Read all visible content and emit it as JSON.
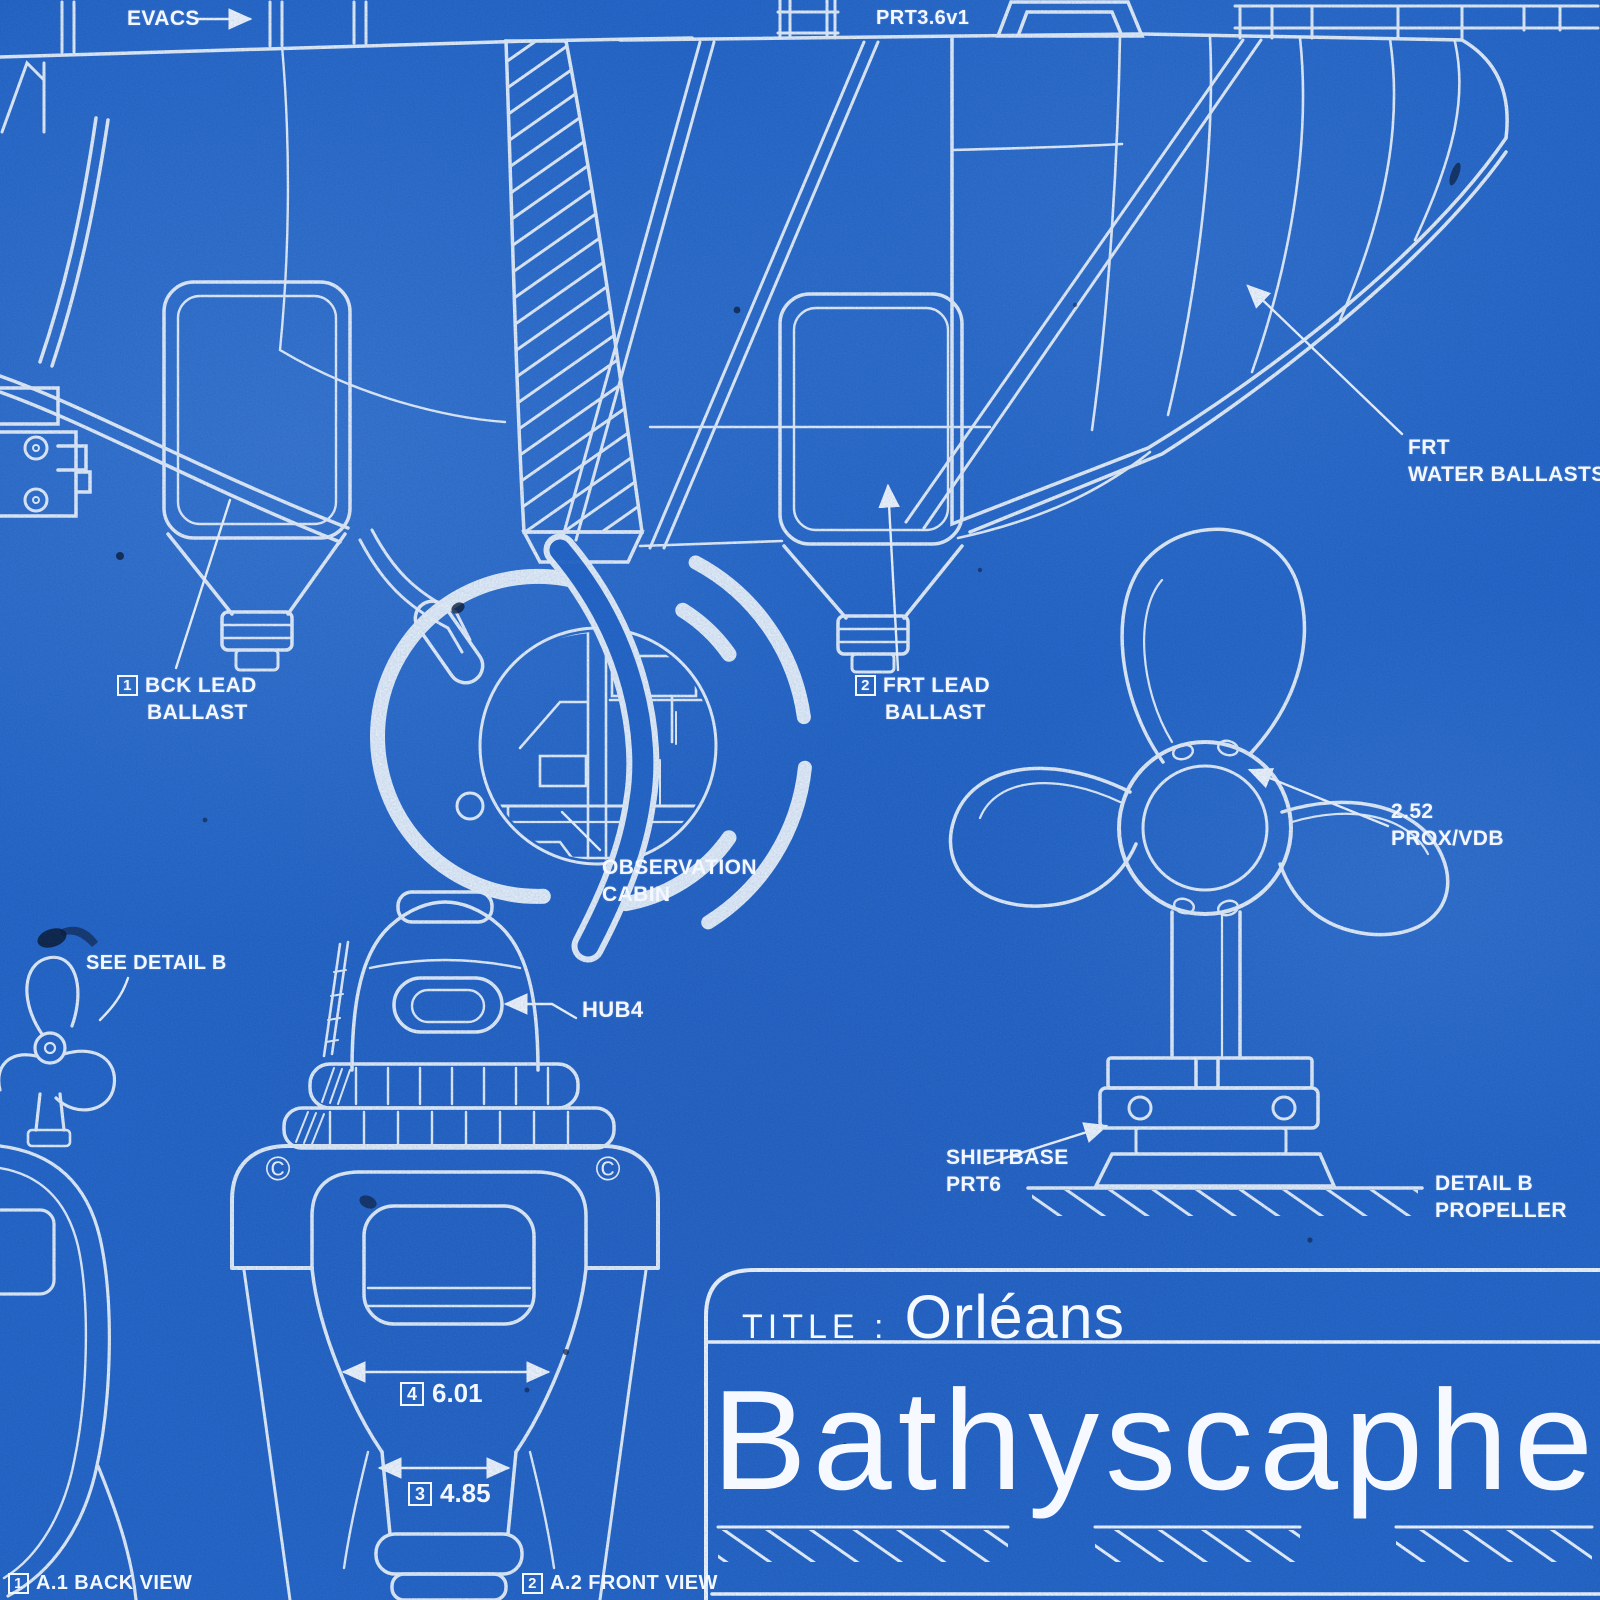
{
  "poster": {
    "colors": {
      "paper": "#1f60c6",
      "ink": "#f3f7ff"
    },
    "labels": {
      "evacs": "EVACS",
      "part_number": "PRT3.6v1",
      "bck_lead_ballast": {
        "ref": "1",
        "line1": "BCK LEAD",
        "line2": "BALLAST"
      },
      "frt_lead_ballast": {
        "ref": "2",
        "line1": "FRT LEAD",
        "line2": "BALLAST"
      },
      "frt_water_ballasts": {
        "line1": "FRT",
        "line2": "WATER BALLASTS"
      },
      "observation_cabin": {
        "line1": "OBSERVATION",
        "line2": "CABIN"
      },
      "prox_vdb": {
        "line1": "2.52",
        "line2": "PROX/VDB"
      },
      "shiftbase": {
        "line1": "SHIFTBASE",
        "line2": "PRT6"
      },
      "detail_b": {
        "line1": "DETAIL B",
        "line2": "PROPELLER"
      },
      "see_detail_b": "SEE DETAIL B",
      "hub4": "HUB4"
    },
    "dimensions": {
      "width": {
        "ref": "4",
        "value": "6.01"
      },
      "lower_width": {
        "ref": "3",
        "value": "4.85"
      }
    },
    "views": {
      "back": {
        "ref": "1",
        "label": "A.1 BACK VIEW"
      },
      "front": {
        "ref": "2",
        "label": "A.2 FRONT VIEW"
      }
    },
    "marks": {
      "copyright": "©"
    },
    "title_block": {
      "title_label": "TITLE :",
      "title_value": "Orléans",
      "name": "Bathyscaphe"
    }
  }
}
